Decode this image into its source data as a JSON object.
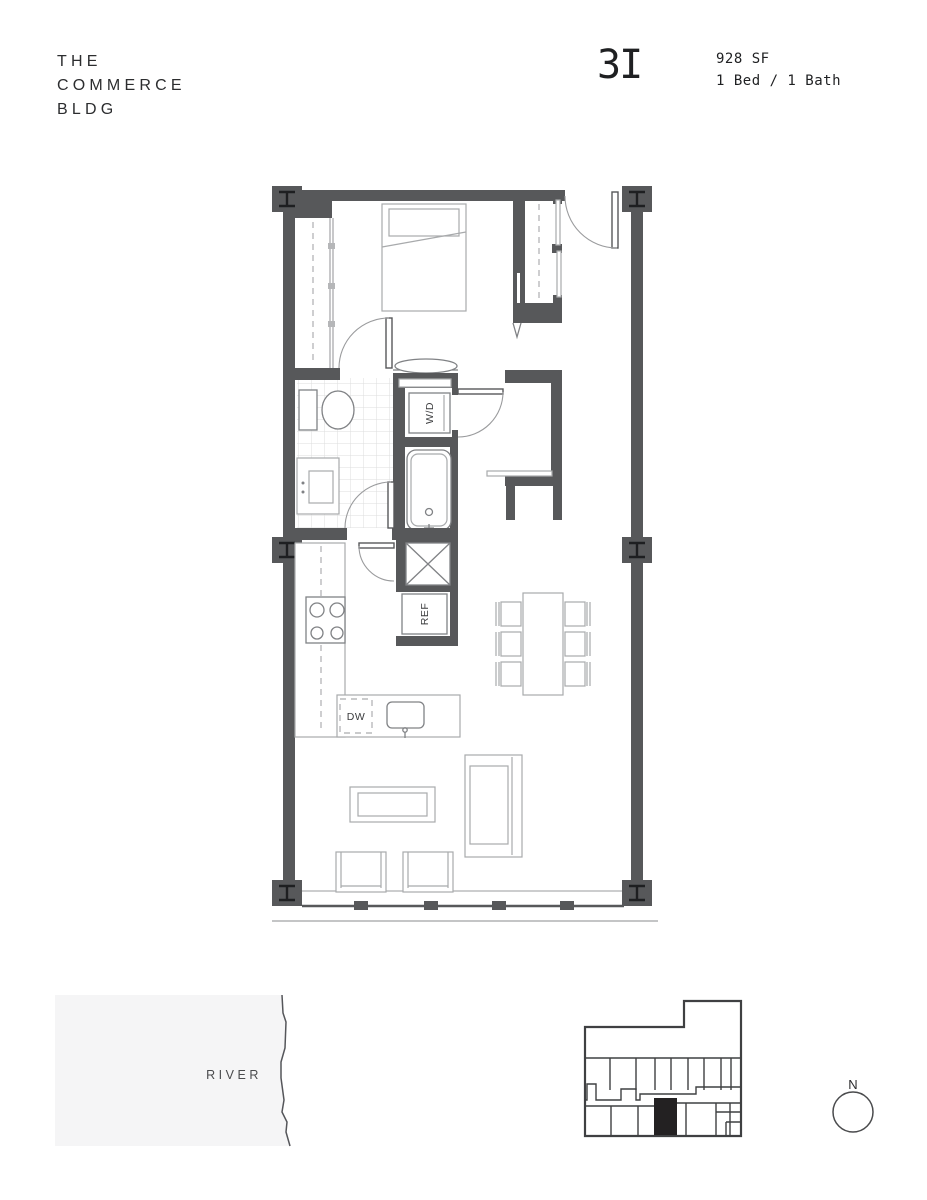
{
  "brand": {
    "line1": "THE",
    "line2": "COMMERCE",
    "line3": "BLDG"
  },
  "unit": {
    "number": "3I",
    "area": "928 SF",
    "layout": "1 Bed / 1 Bath"
  },
  "plan": {
    "labels": {
      "washer_dryer": "W/D",
      "refrigerator": "REF",
      "dishwasher": "DW"
    },
    "colors": {
      "wall": "#57585a",
      "furniture": "#a8aaac",
      "medium": "#808285",
      "tile": "#dcdddd",
      "dash": "#b9babc"
    }
  },
  "site_map": {
    "river_label": "RIVER",
    "fill": "#f5f5f6",
    "line": "#55565a"
  },
  "key_plan": {
    "unit_fill": "#232122",
    "line": "#3f4042"
  },
  "compass": {
    "label": "N"
  }
}
